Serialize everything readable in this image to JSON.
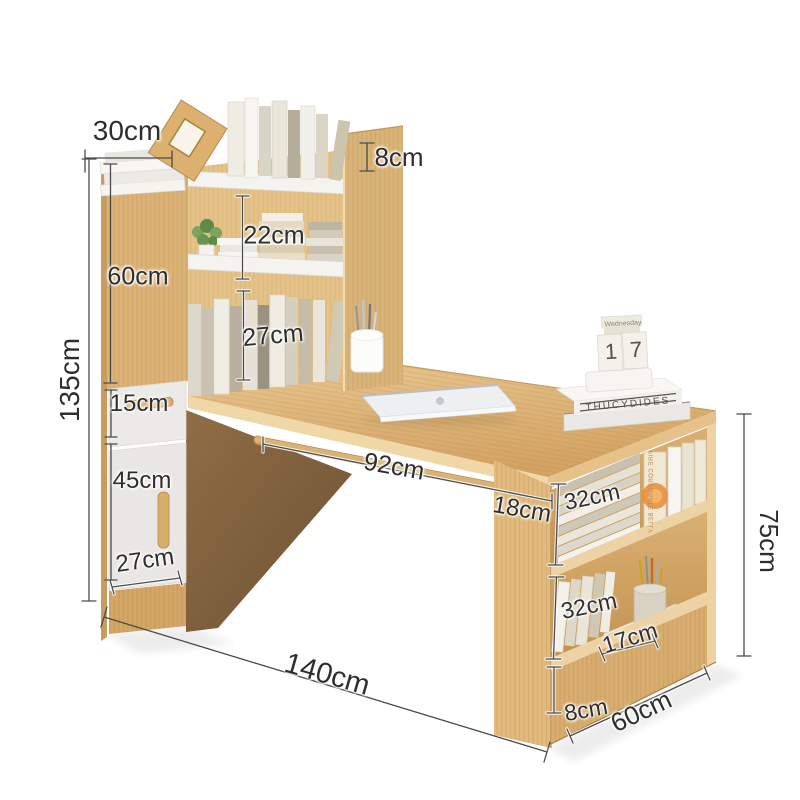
{
  "diagram": {
    "title_hint": "desk with bookshelf dimension diagram",
    "unit": "cm",
    "dimensions": {
      "top_depth": "30cm",
      "top_rim_height": "8cm",
      "upper_shelf_height": "22cm",
      "upper_section_height": "60cm",
      "lower_shelf_height": "27cm",
      "total_height": "135cm",
      "drawer_height": "15cm",
      "door_height": "45cm",
      "cabinet_width": "27cm",
      "desk_opening_width": "92cm",
      "support_panel_width": "18cm",
      "right_shelf_top_height": "32cm",
      "right_shelf_bottom_height": "32cm",
      "right_shelf_depth": "17cm",
      "right_base_height": "8cm",
      "right_case_depth": "60cm",
      "right_case_height": "75cm",
      "overall_width": "140cm"
    }
  },
  "props": {
    "calendar": {
      "weekday": "Wednesday",
      "day_left": "1",
      "day_right": "7"
    },
    "desk_book_spine": "THUCYDIDES",
    "shelf_book_spine": "FIRE CORPORATE BELLY"
  },
  "colors": {
    "background": "#ffffff",
    "wood_main": "#dcb377",
    "wood_light": "#f0d8ab",
    "wood_shadow": "#8a6a45",
    "shelf_white": "#f3f2ef",
    "drawer_white": "#eceae6",
    "accent_orange": "#e0813a",
    "dim_line": "#4b4b4b",
    "label_text": "#2e2e2e"
  }
}
